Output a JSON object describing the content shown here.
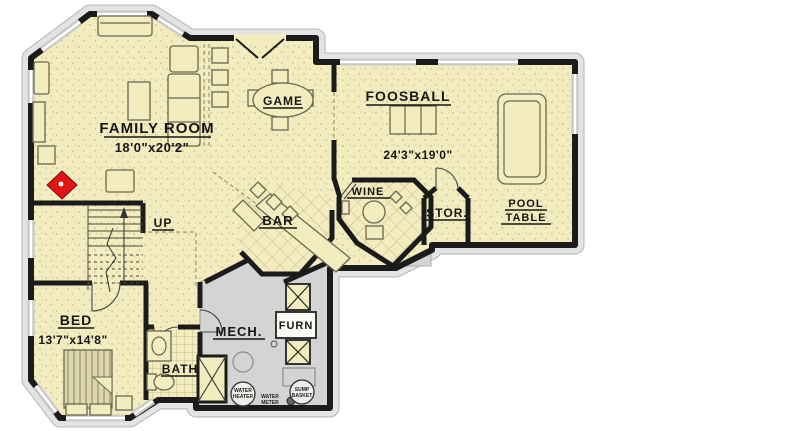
{
  "plan": {
    "type": "basement-floor-plan",
    "labels": {
      "family_room": "FAMILY ROOM",
      "family_room_dims": "18'0\"x20'2\"",
      "game": "GAME",
      "foosball": "FOOSBALL",
      "rec_room_dims": "24'3\"x19'0\"",
      "wine": "WINE",
      "bar": "BAR",
      "stor": "STOR.",
      "pool_line1": "POOL",
      "pool_line2": "TABLE",
      "up": "UP",
      "bed": "BED",
      "bed_dims": "13'7\"x14'8\"",
      "bath": "BATH",
      "mech": "MECH.",
      "furn": "FURN",
      "water_heater_line1": "WATER",
      "water_heater_line2": "HEATER",
      "water_meter_line1": "WATER",
      "water_meter_line2": "METER",
      "sump_line1": "SUMP",
      "sump_line2": "BASKET"
    },
    "colors": {
      "floor": "#f2ecbf",
      "slab_gray": "#d4d4d4",
      "wall_black": "#1b1b1b",
      "fireplace_red": "#e11414",
      "edging_gray": "#e3e3e3",
      "tile_line": "#c6bc8e"
    }
  }
}
